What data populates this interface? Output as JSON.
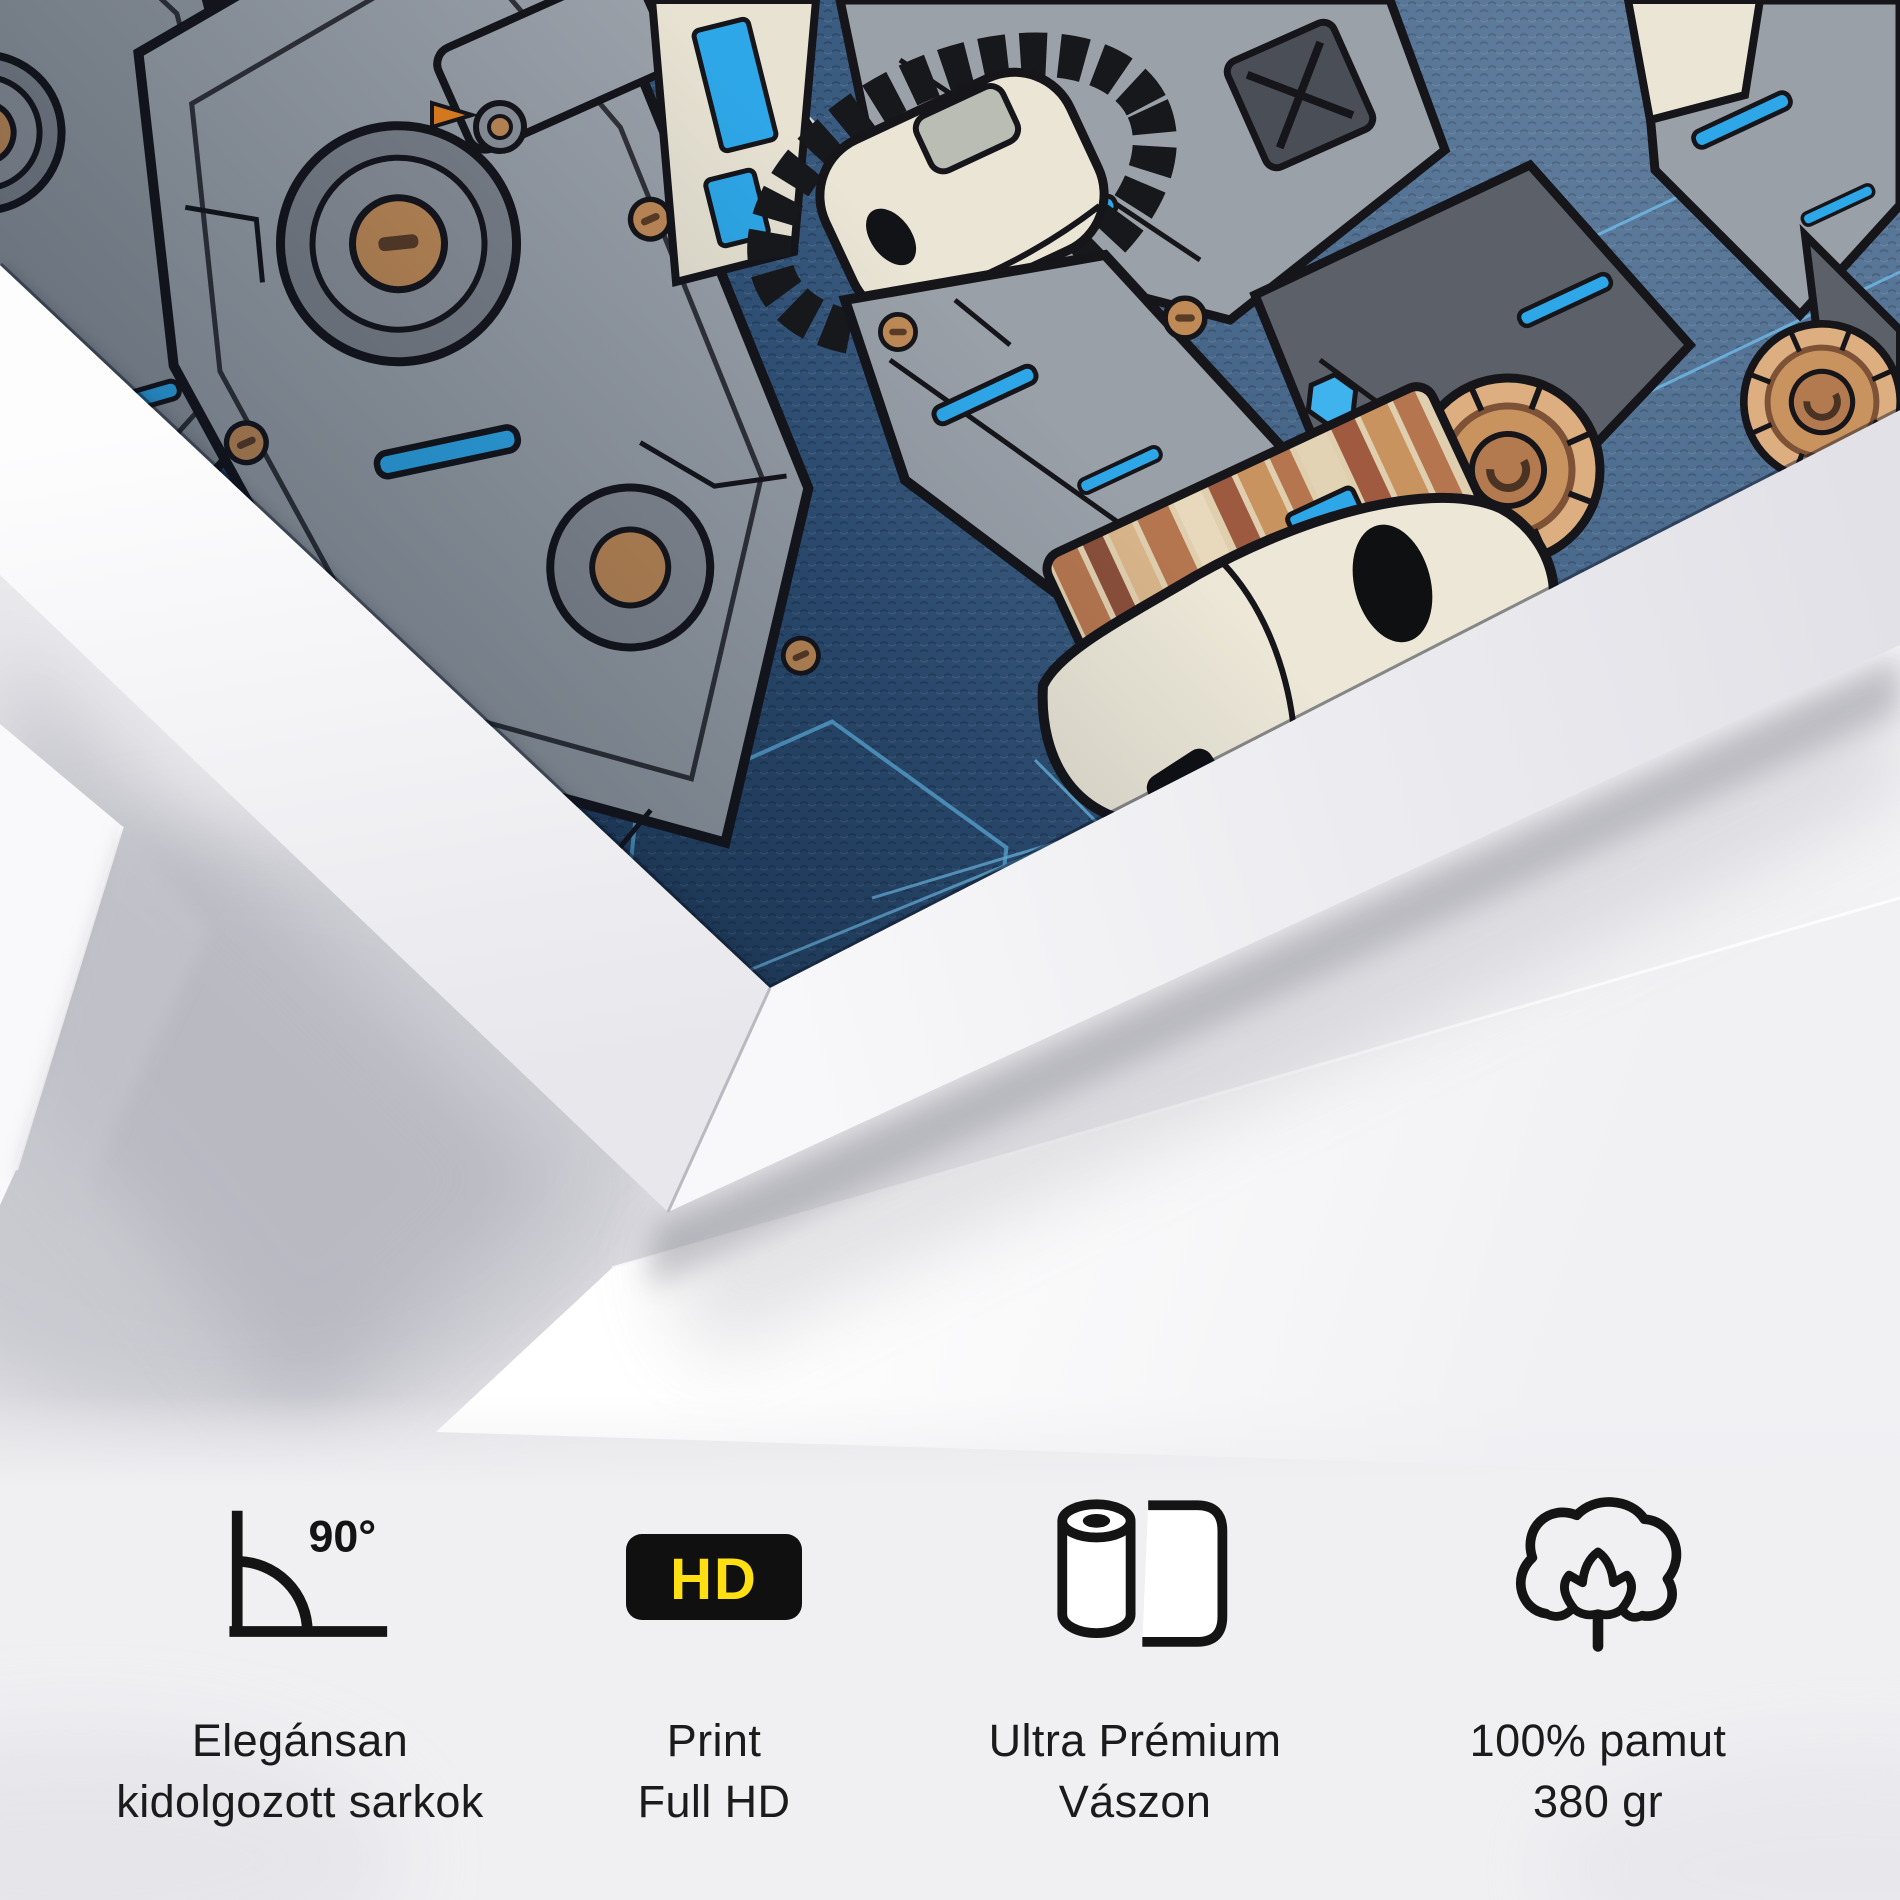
{
  "scene": {
    "description": "White-framed canvas print leaning at an angle showing a sci-fi mecha robot blueprint illustration, resting on a flat white canvas",
    "artwork_colors": {
      "canvas_blue": "#2e5076",
      "canvas_blue_dark": "#1d3a58",
      "grid_line_blue": "#6fbce8",
      "accent_blue": "#2ea7e8",
      "metal_gray": "#99a0a8",
      "dark_gray": "#5c6169",
      "copper": "#c08a56",
      "cream": "#eae5d5",
      "tan": "#d9b58a",
      "outline": "#15151a"
    },
    "frame_color": "#f5f5f8",
    "backdrop_color": "#ededf0"
  },
  "features": [
    {
      "icon": "corner-90-icon",
      "angle_label": "90°",
      "line1": "Elegánsan",
      "line2": "kidolgozott sarkok"
    },
    {
      "icon": "hd-badge-icon",
      "badge_label": "HD",
      "line1": "Print",
      "line2": "Full HD"
    },
    {
      "icon": "canvas-roll-icon",
      "line1": "Ultra Prémium",
      "line2": "Vászon"
    },
    {
      "icon": "cotton-icon",
      "line1": "100% pamut",
      "line2": "380 gr"
    }
  ],
  "badge_colors": {
    "hd_background": "#101010",
    "hd_text": "#ffdf12",
    "icon_stroke": "#141414"
  }
}
